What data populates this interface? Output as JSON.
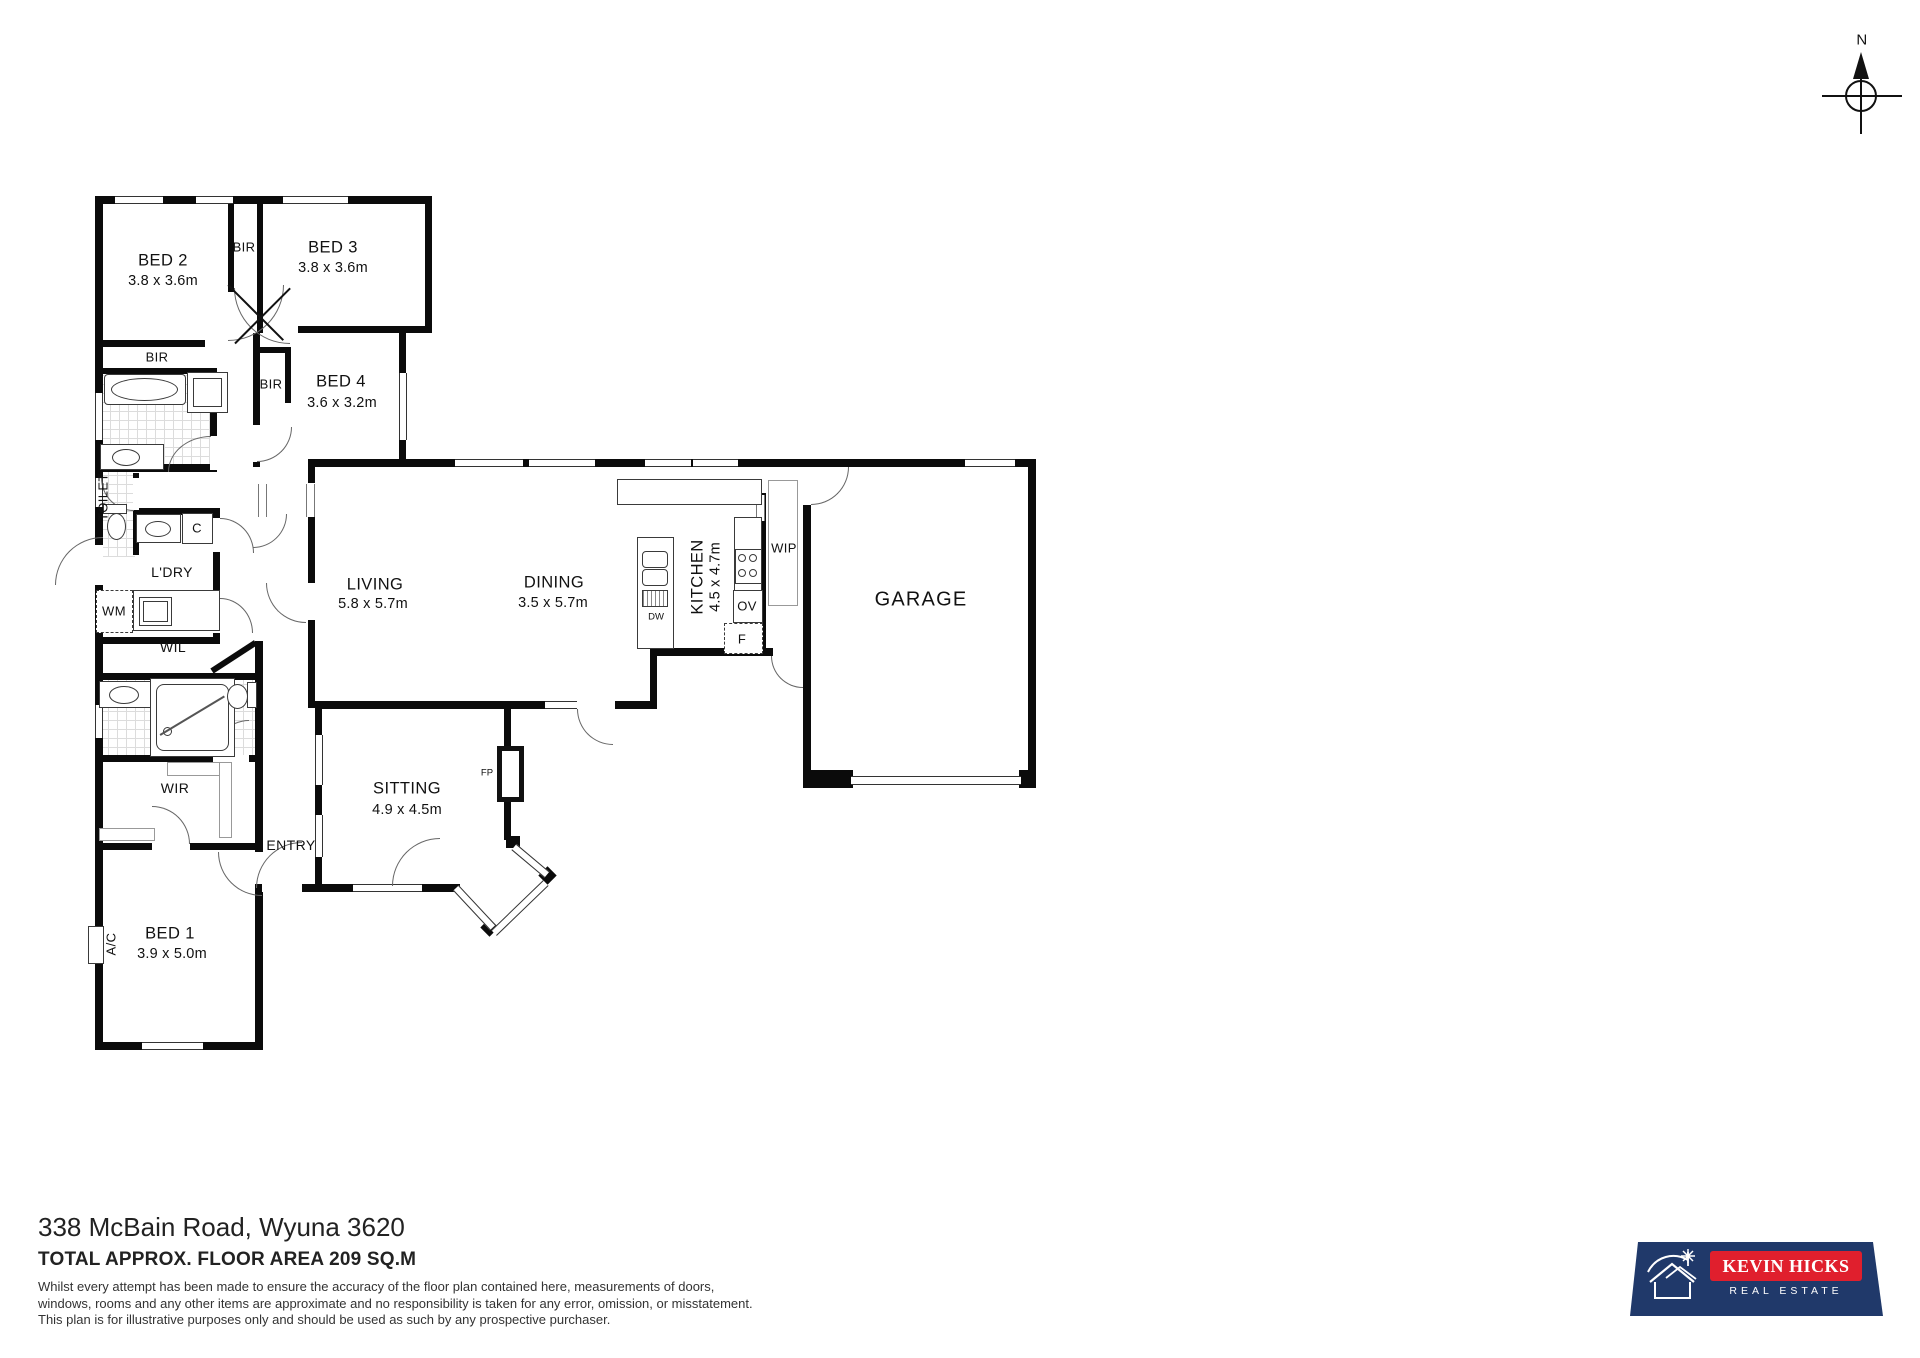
{
  "compass": {
    "north": "N"
  },
  "rooms": {
    "bed1": {
      "label": "BED 1",
      "dims": "3.9 x 5.0m"
    },
    "bed2": {
      "label": "BED 2",
      "dims": "3.8 x 3.6m"
    },
    "bed3": {
      "label": "BED 3",
      "dims": "3.8 x 3.6m"
    },
    "bed4": {
      "label": "BED 4",
      "dims": "3.6 x 3.2m"
    },
    "living": {
      "label": "LIVING",
      "dims": "5.8 x 5.7m"
    },
    "dining": {
      "label": "DINING",
      "dims": "3.5 x 5.7m"
    },
    "kitchen": {
      "label": "KITCHEN",
      "dims": "4.5 x 4.7m"
    },
    "sitting": {
      "label": "SITTING",
      "dims": "4.9 x 4.5m"
    },
    "garage": {
      "label": "GARAGE"
    },
    "entry": {
      "label": "ENTRY"
    },
    "laundry": {
      "label": "L'DRY"
    },
    "toilet": {
      "label": "TOILET"
    },
    "walk_in_linen": {
      "label": "WIL"
    },
    "walk_in_robe": {
      "label": "WIR"
    }
  },
  "fixtures": {
    "built_in_robe": "BIR",
    "walk_in_pantry": "WIP",
    "oven": "OV",
    "fridge": "F",
    "dishwasher": "DW",
    "washing_machine": "WM",
    "cupboard": "C",
    "fireplace": "FP",
    "air_conditioner": "A/C"
  },
  "footer": {
    "address": "338 McBain Road, Wyuna 3620",
    "floor_area": "TOTAL APPROX. FLOOR AREA 209 SQ.M",
    "disclaimer_line1": "Whilst every attempt has been made to ensure the accuracy of the floor plan contained here, measurements of doors,",
    "disclaimer_line2": "windows, rooms and any other items are approximate and no responsibility is taken for any error, omission, or misstatement.",
    "disclaimer_line3": "This plan is for illustrative purposes only and should be used as such by any prospective purchaser."
  },
  "logo": {
    "brand": "KEVIN HICKS",
    "tagline": "REAL ESTATE",
    "banner_color": "#20396a",
    "accent_color": "#e01f2d"
  }
}
